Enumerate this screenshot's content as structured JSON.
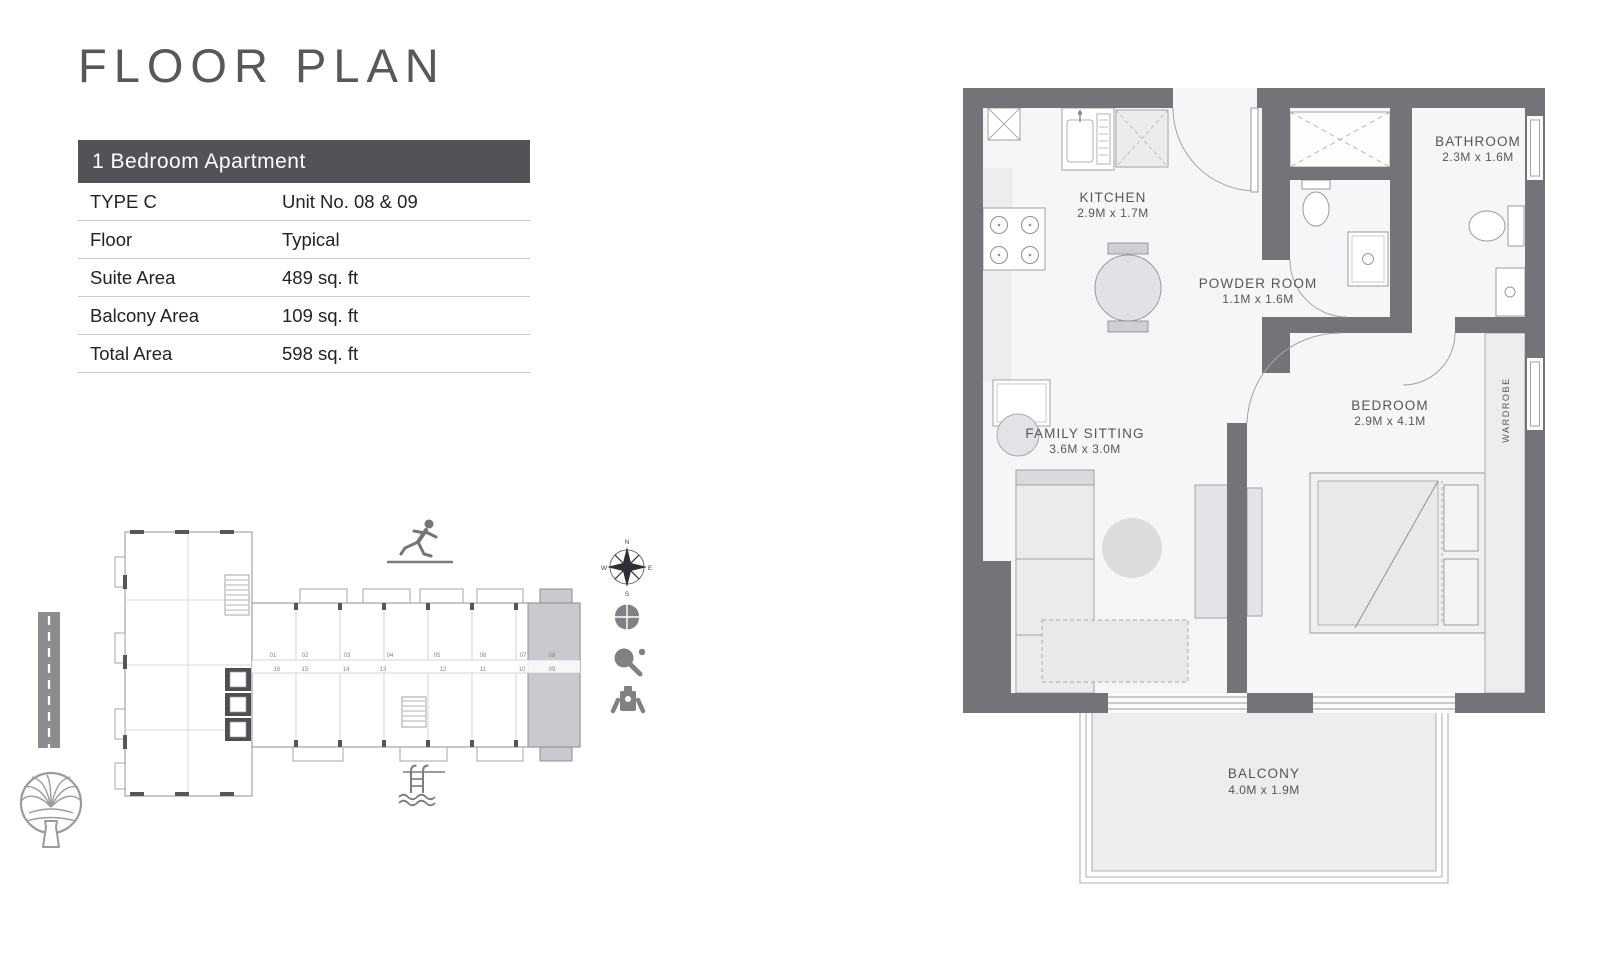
{
  "title": "FLOOR PLAN",
  "unit_table": {
    "header": "1 Bedroom Apartment",
    "rows": [
      {
        "label": "TYPE C",
        "value": "Unit No. 08 & 09"
      },
      {
        "label": "Floor",
        "value": "Typical"
      },
      {
        "label": "Suite Area",
        "value": "489 sq. ft"
      },
      {
        "label": "Balcony Area",
        "value": "109 sq. ft"
      },
      {
        "label": "Total Area",
        "value": "598 sq. ft"
      }
    ]
  },
  "plan": {
    "kitchen": {
      "name": "KITCHEN",
      "dims": "2.9M x 1.7M"
    },
    "powder": {
      "name": "POWDER ROOM",
      "dims": "1.1M x 1.6M"
    },
    "bathroom": {
      "name": "BATHROOM",
      "dims": "2.3M x 1.6M"
    },
    "family": {
      "name": "FAMILY SITTING",
      "dims": "3.6M x 3.0M"
    },
    "bedroom": {
      "name": "BEDROOM",
      "dims": "2.9M x 4.1M"
    },
    "balcony": {
      "name": "BALCONY",
      "dims": "4.0M x 1.9M"
    },
    "wardrobe": {
      "name": "WARDROBE"
    }
  },
  "key_plan": {
    "units_top": [
      "01",
      "02",
      "03",
      "04",
      "05",
      "06",
      "07",
      "08"
    ],
    "units_bottom": [
      "16",
      "15",
      "14",
      "13",
      "12",
      "11",
      "10",
      "09"
    ],
    "highlighted_units": "08 & 09",
    "compass": {
      "n": "N",
      "e": "E",
      "s": "S",
      "w": "W"
    },
    "amenity_icons": [
      "running-track",
      "compass",
      "basketball",
      "table-tennis",
      "gym",
      "swimming-pool"
    ]
  },
  "colors": {
    "wall": "#747478",
    "header_bar": "#545157",
    "highlight_unit": "#c9c9ce",
    "floor": "#f6f6f8"
  }
}
